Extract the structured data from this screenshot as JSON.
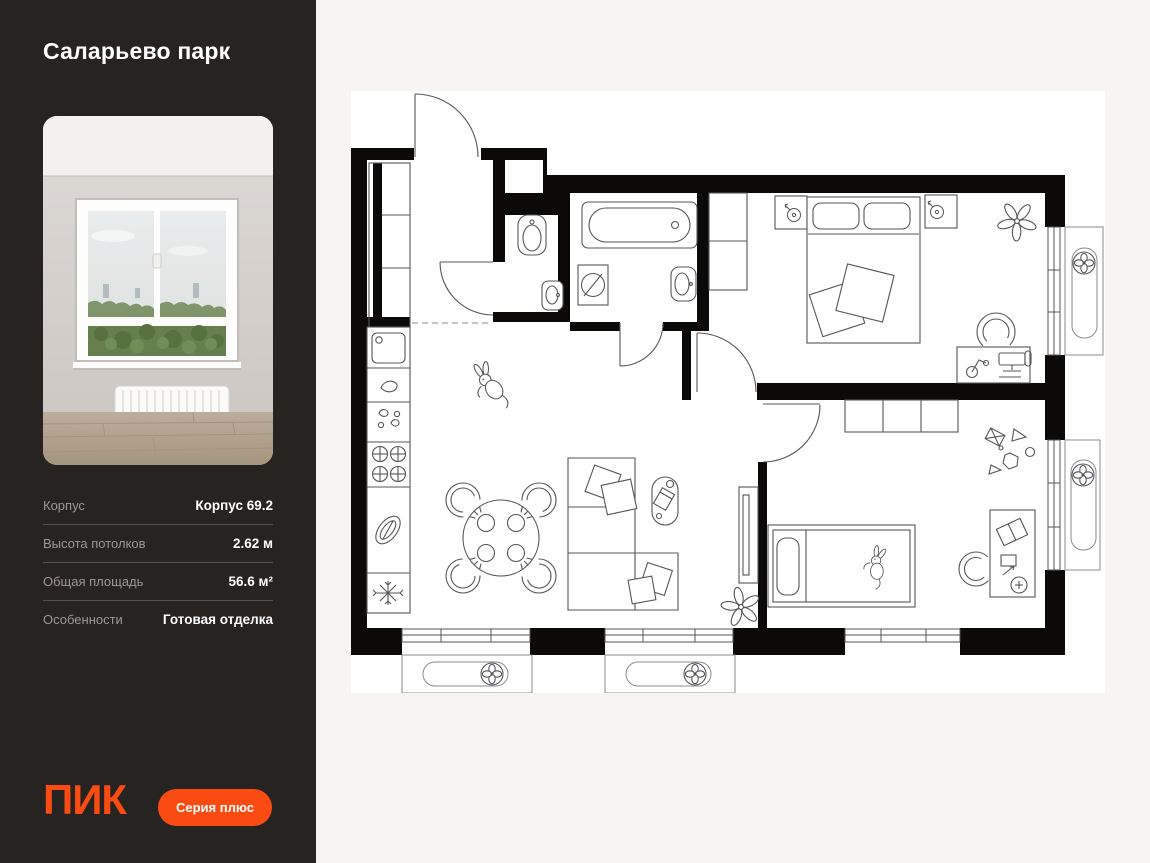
{
  "page": {
    "background": "#f6f5f3"
  },
  "sidebar": {
    "background": "#272321",
    "title": "Саларьево парк",
    "photo_description": "empty room with window view of trees",
    "specs": [
      {
        "label": "Корпус",
        "value": "Корпус 69.2"
      },
      {
        "label": "Высота потолков",
        "value": "2.62 м"
      },
      {
        "label": "Общая площадь",
        "value": "56.6 м²"
      },
      {
        "label": "Особенности",
        "value": "Готовая отделка"
      }
    ],
    "logo_text": "ПИК",
    "badge_label": "Серия плюс",
    "accent_color": "#fa4b12"
  },
  "floorplan": {
    "background": "#ffffff",
    "wall_color": "#0b0a09",
    "line_color": "#55565a",
    "depicted_elements": [
      "entry-door",
      "hall-cabinet",
      "toilet",
      "bathtub",
      "washing-machine",
      "sinks",
      "kitchen-hob",
      "fridge",
      "dining-table-4-chairs",
      "corner-sofa",
      "double-bed",
      "single-bed",
      "wardrobe",
      "desks",
      "desk-chairs",
      "plants",
      "toy-bunny",
      "tv-stand",
      "balcony-ac-units",
      "windows"
    ]
  }
}
